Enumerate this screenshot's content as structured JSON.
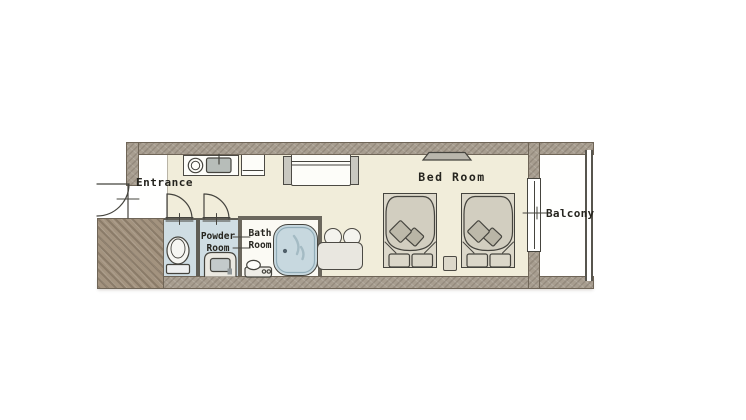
{
  "rooms": {
    "entrance": {
      "label": "Entrance"
    },
    "powder_room": {
      "line1": "Powder",
      "line2": "Room"
    },
    "bath_room": {
      "line1": "Bath",
      "line2": "Room"
    },
    "bed_room": {
      "label": "Bed Room"
    },
    "balcony": {
      "label": "Balcony"
    }
  },
  "fixtures": [
    "entrance-door",
    "kitchen-counter",
    "stove-burner",
    "kitchen-sink",
    "refrigerator",
    "sofa",
    "air-conditioner-unit",
    "interior-door",
    "interior-door",
    "toilet",
    "vanity-sink",
    "shower-faucet",
    "bathtub",
    "table",
    "stool",
    "stool",
    "bed",
    "bed",
    "nightstand",
    "balcony-window",
    "balcony-railing"
  ],
  "colors": {
    "wall": "#a89e90",
    "wall_mass": "#a3937f",
    "floor_main": "#f1edda",
    "floor_light": "#ffffff",
    "wet_room": "#cfdde3",
    "bathtub": "#c7d8df",
    "furniture": "#dcd8ca",
    "line": "#45443e"
  }
}
